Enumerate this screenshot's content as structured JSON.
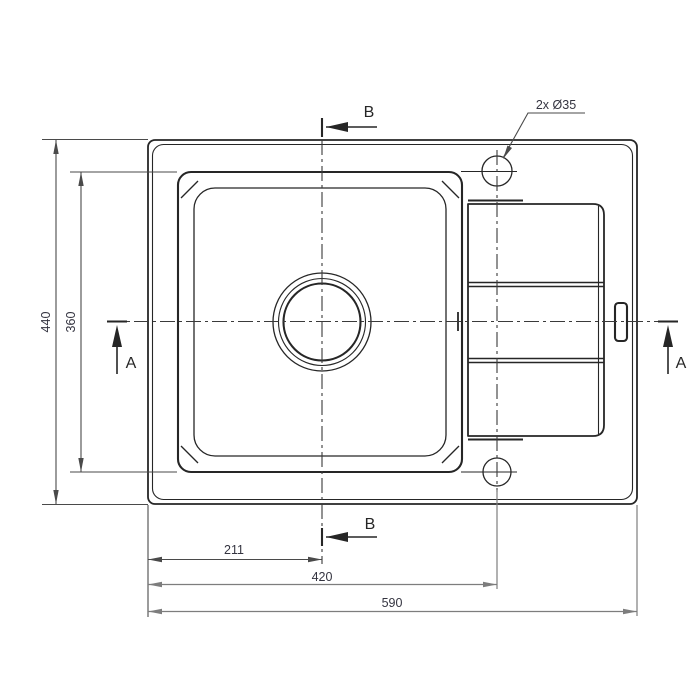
{
  "drawing": {
    "dimensions": {
      "overall_depth": "440",
      "bowl_depth": "360",
      "drain_offset": "211",
      "hole_span": "420",
      "overall_width": "590",
      "tap_hole_note": "2x Ø35"
    },
    "section_labels": {
      "a_left": "A",
      "a_right": "A",
      "b_top": "B",
      "b_bottom": "B"
    },
    "colors": {
      "background": "#ffffff",
      "object_line": "#262626",
      "centerline": "#3a3a3a",
      "dim_line": "#4a4a4a",
      "light_dim_line": "#7d7d7d",
      "text": "#343440"
    }
  }
}
